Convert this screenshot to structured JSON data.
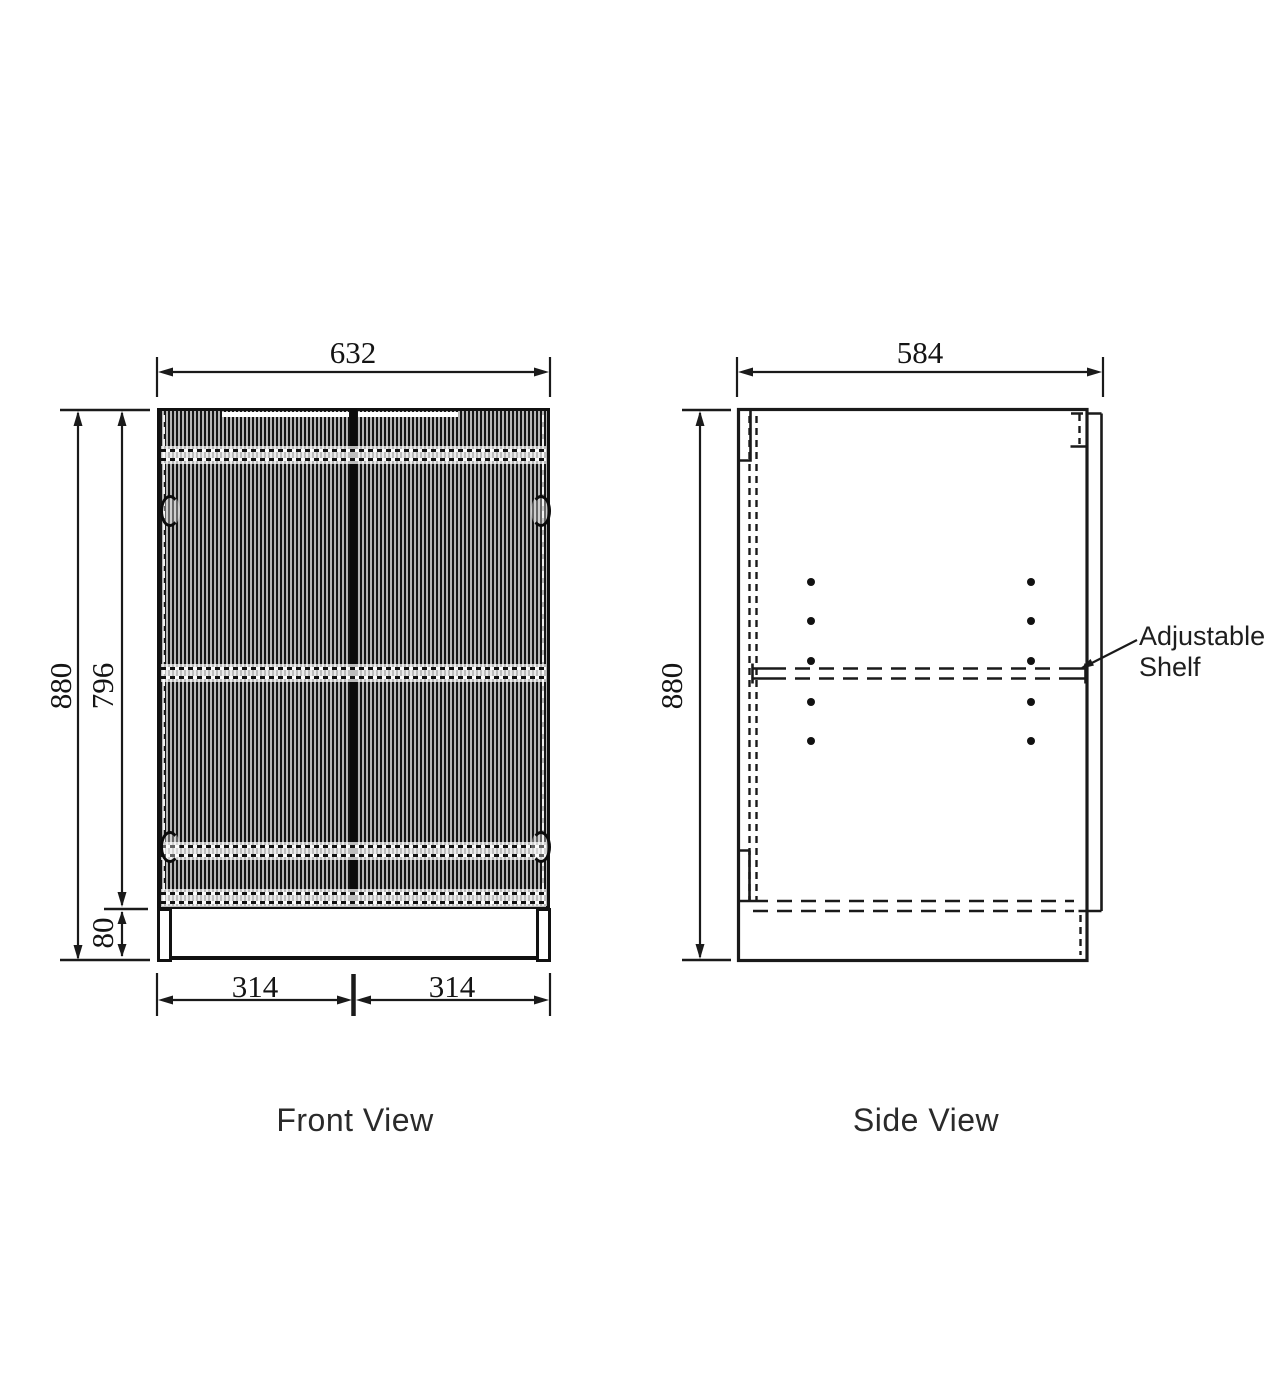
{
  "drawing": {
    "front_view": {
      "label": "Front View",
      "dim_overall_width": "632",
      "dim_overall_height": "880",
      "dim_door_height": "796",
      "dim_kick_height": "80",
      "dim_door_left_width": "314",
      "dim_door_right_width": "314"
    },
    "side_view": {
      "label": "Side View",
      "dim_depth": "584",
      "dim_overall_height": "880",
      "annotation_line1": "Adjustable",
      "annotation_line2": "Shelf"
    },
    "colors": {
      "line": "#1a1a1a",
      "background": "#ffffff",
      "flute_dark": "#151515",
      "flute_light": "#b5b5b5"
    }
  }
}
